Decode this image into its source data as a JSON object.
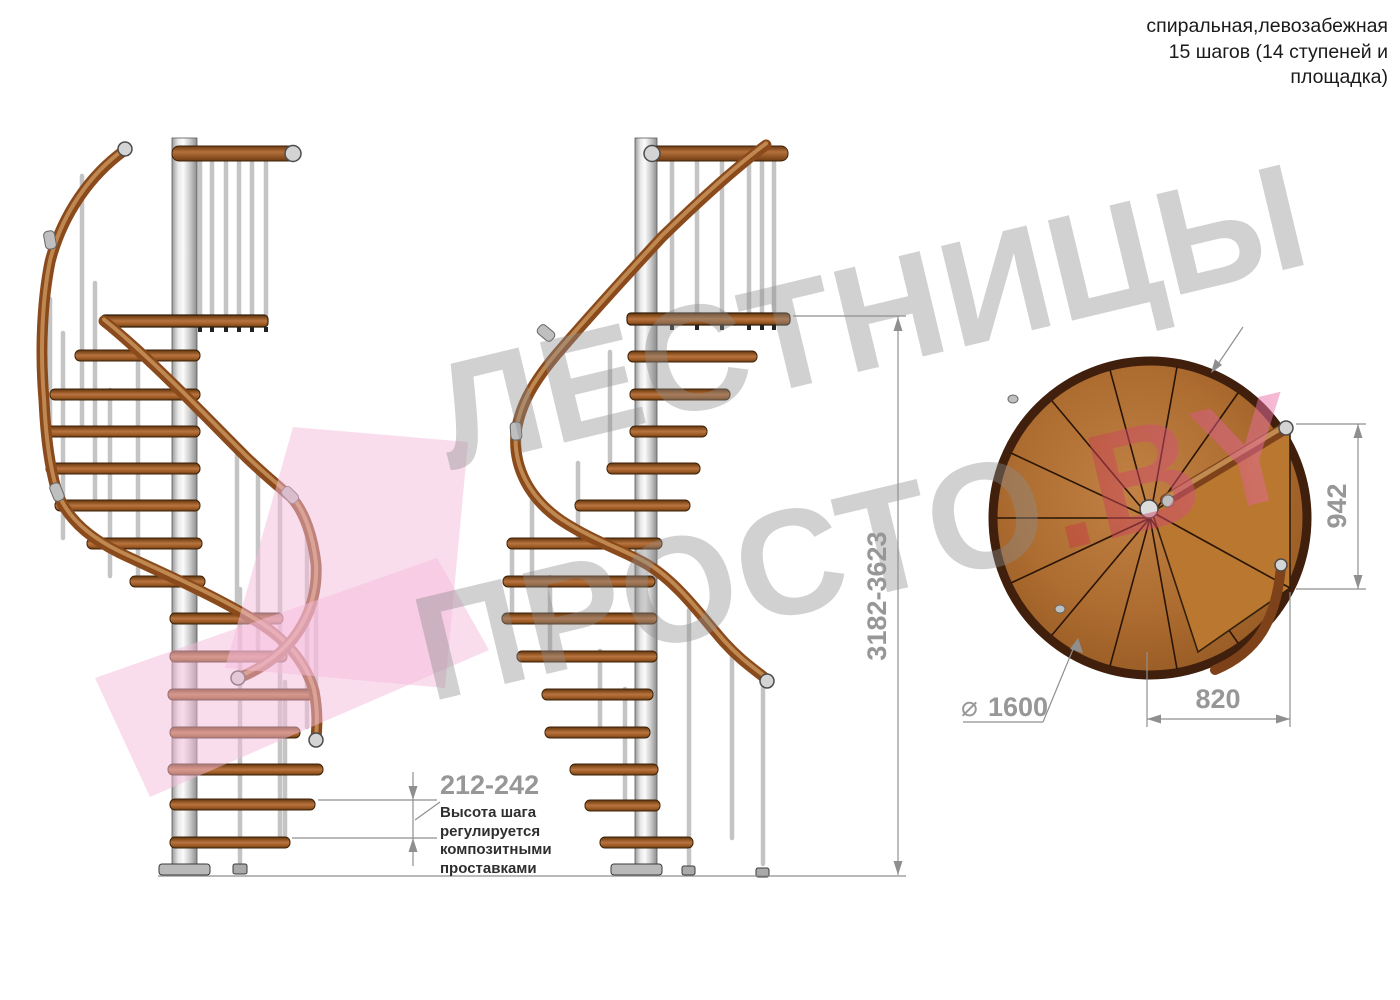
{
  "title": {
    "line1": "спиральная,левозабежная",
    "line2": "15 шагов (14 ступеней и",
    "line3": "площадка)"
  },
  "dimensions": {
    "total_height": "3182-3623",
    "step_height": "212-242",
    "landing_width": "942",
    "landing_depth": "820",
    "diameter_symbol": "⌀",
    "diameter": "1600"
  },
  "notes": {
    "step_height_note": "Высота шага регулируется композитными проставками"
  },
  "watermark": {
    "line1": "ЛЕСТНИЦЫ",
    "line2": "ПРОСТО",
    "suffix": ".BY"
  },
  "colors": {
    "wood": "#a86229",
    "wood_dark": "#5d3311",
    "rail": "#8a4a1c",
    "steel": "#cfcfcf",
    "dimension_gray": "#979797",
    "watermark_gray": "#8d8d8d",
    "watermark_pink": "#f5bcdc",
    "watermark_red": "#c23b3b"
  }
}
